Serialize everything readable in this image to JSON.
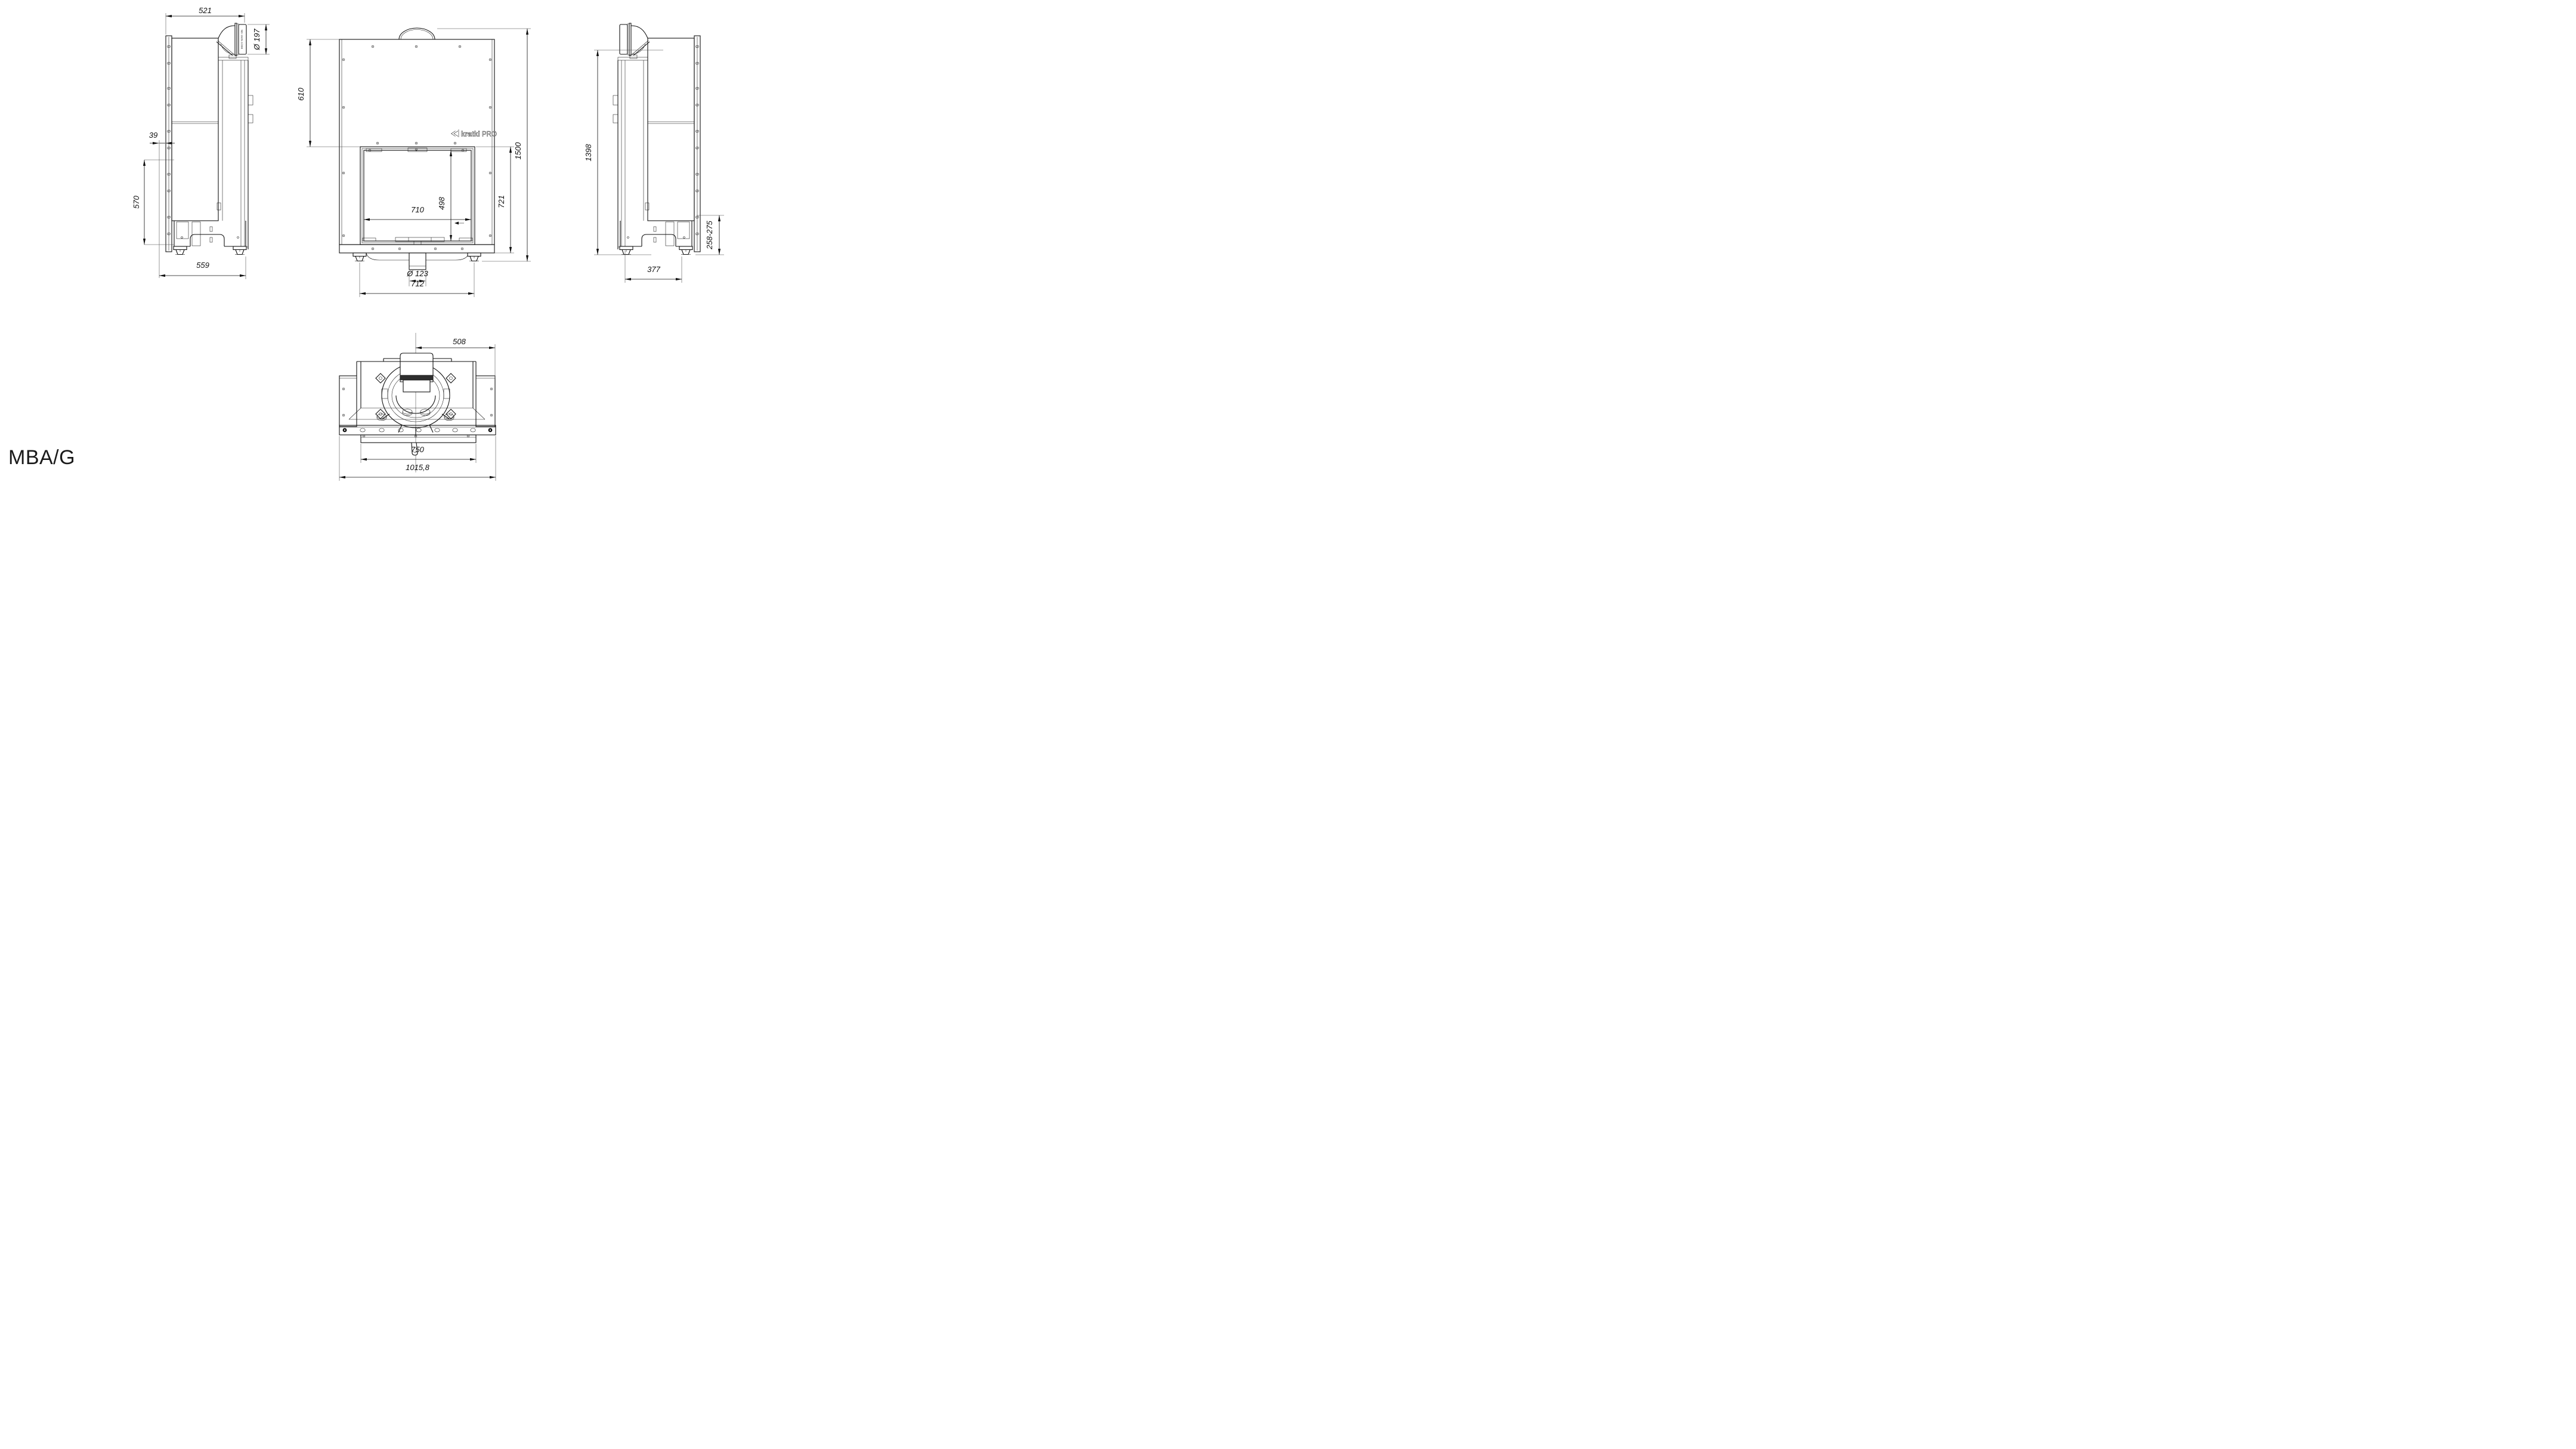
{
  "title": "MBA/G",
  "brand": {
    "name": "kratki",
    "suffix": "PRO"
  },
  "views": {
    "left": {
      "dims": {
        "top_width": "521",
        "flue_diameter": "Ø 197",
        "front_offset": "39",
        "glass_height": "570",
        "base_depth": "559"
      },
      "pipe_marking": "ND-1525-1/200"
    },
    "front": {
      "dims": {
        "top_to_window": "610",
        "window_width": "710",
        "window_height": "498",
        "window_to_base": "721",
        "total_height": "1500",
        "air_inlet_diameter": "Ø 123",
        "feet_spacing": "712"
      }
    },
    "right": {
      "dims": {
        "body_height": "1398",
        "base_height_range": "258-275",
        "base_depth": "377"
      }
    },
    "top": {
      "dims": {
        "flue_center_to_edge": "508",
        "inner_width": "750",
        "total_width": "1015,8"
      }
    }
  }
}
